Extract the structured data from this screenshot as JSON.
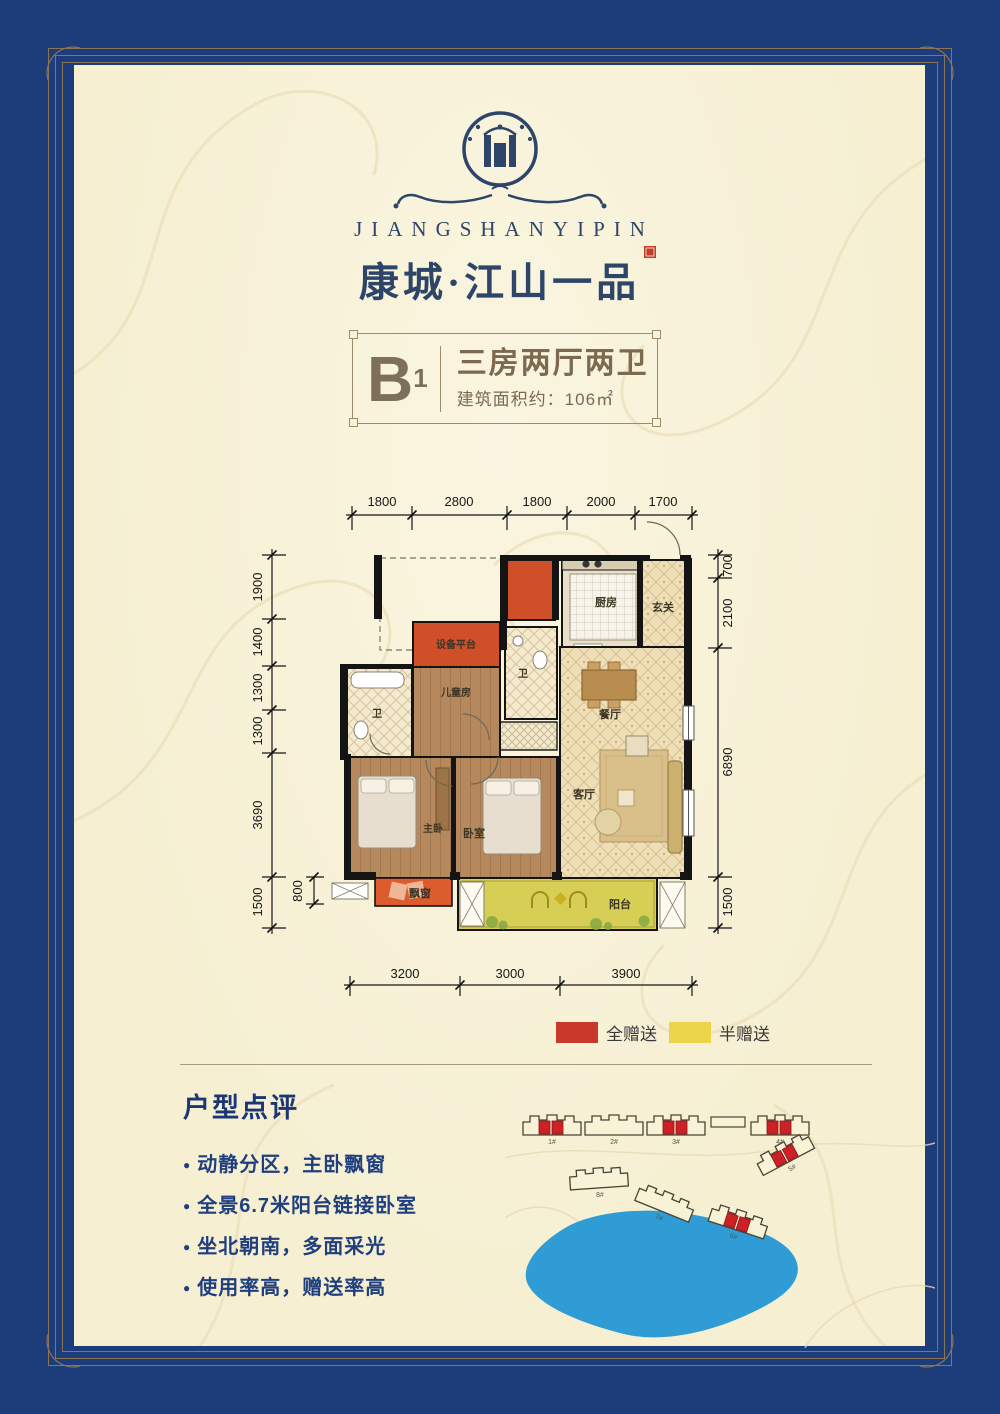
{
  "brand": {
    "romanized": "JIANGSHANYIPIN",
    "name": "康城·江山一品"
  },
  "unit": {
    "code": "B",
    "sub": "1",
    "type_title": "三房两厅两卫",
    "area": "建筑面积约：106㎡"
  },
  "floorplan": {
    "rooms": {
      "kitchen": "厨房",
      "foyer": "玄关",
      "equipment": "设备平台",
      "kids_room": "儿童房",
      "bath1": "卫",
      "bath2": "卫",
      "dining": "餐厅",
      "living": "客厅",
      "master": "主卧",
      "bedroom": "卧室",
      "bay_window": "飘窗",
      "balcony": "阳台"
    },
    "dims": {
      "top": [
        "1800",
        "2800",
        "1800",
        "2000",
        "1700"
      ],
      "left": [
        "1900",
        "1400",
        "1300",
        "1300",
        "3690",
        "1500"
      ],
      "left_inner": "800",
      "right": [
        "700",
        "2100",
        "6890",
        "1500"
      ],
      "bottom": [
        "3200",
        "3000",
        "3900"
      ]
    }
  },
  "legend": {
    "full": "全赠送",
    "full_color": "#c9392b",
    "half": "半赠送",
    "half_color": "#ead54b"
  },
  "review": {
    "heading": "户型点评",
    "bullets": [
      "动静分区，主卧飘窗",
      "全景6.7米阳台链接卧室",
      "坐北朝南，多面采光",
      "使用率高，赠送率高"
    ]
  },
  "sitemap": {
    "labels": [
      "1#",
      "2#",
      "3#",
      "4#",
      "5#",
      "6#",
      "7#",
      "8#"
    ],
    "highlight_color": "#cc2127",
    "lake_color": "#2f9cd6"
  },
  "colors": {
    "border_blue": "#1d3c7a",
    "panel_cream": "#f8f2d7",
    "gold_line": "#8c7557",
    "brand_navy": "#2c4568",
    "unit_brown": "#7b6a50",
    "review_navy": "#1f3f7e",
    "gift_red": "#cf4f28",
    "gift_yellow": "#d6ce55"
  }
}
